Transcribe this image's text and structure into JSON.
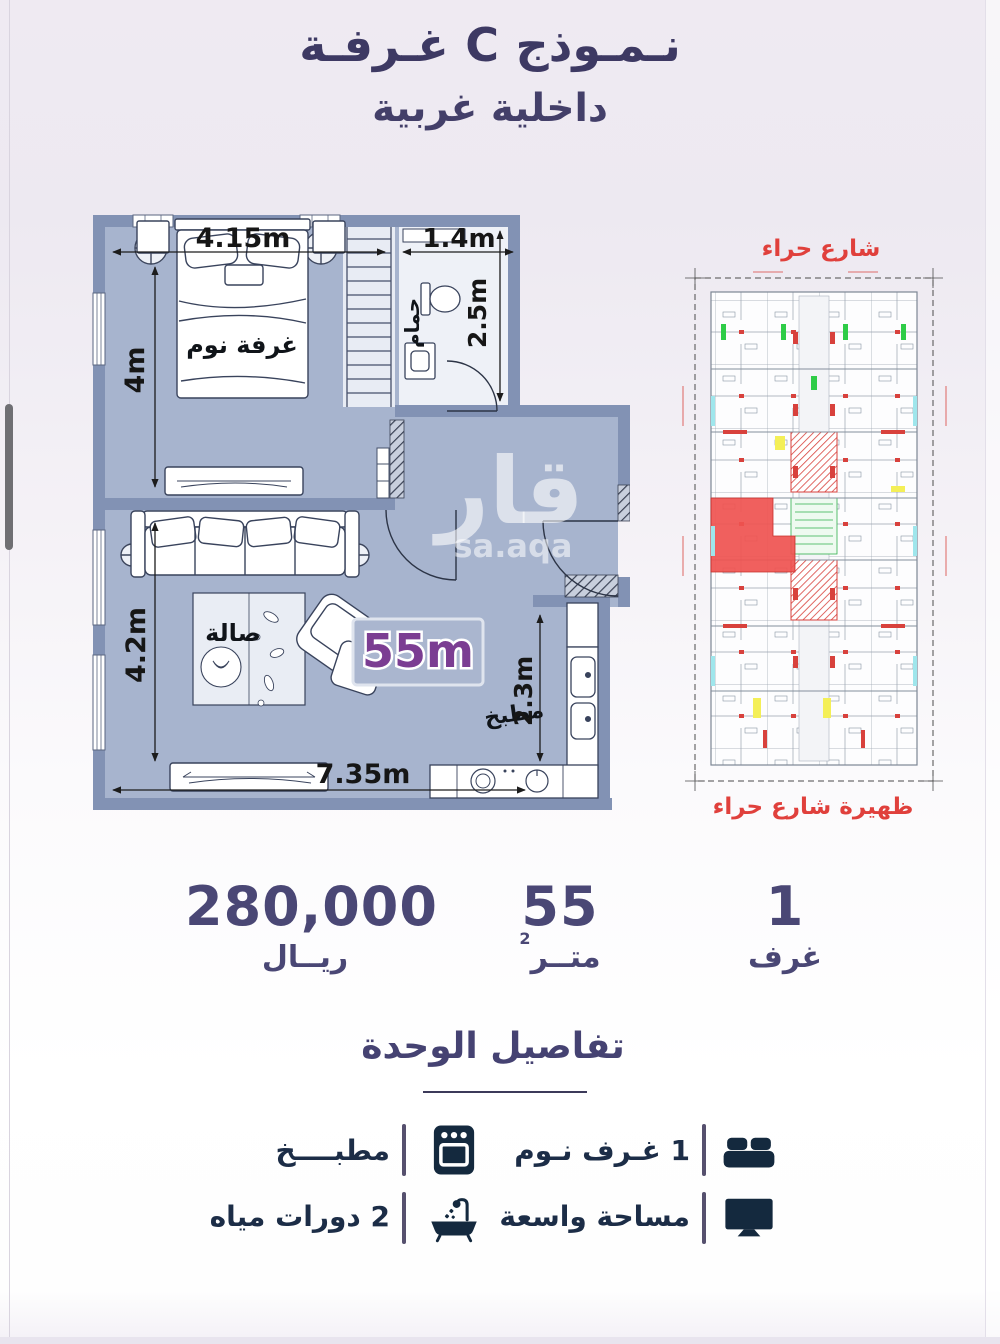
{
  "header": {
    "title_line1": "نـمـوذج C غـرفـة",
    "title_line2": "داخلية غربية"
  },
  "floor_plan": {
    "labels": {
      "bedroom": "غرفة نوم",
      "bathroom": "حمام",
      "living_room": "صالة",
      "kitchen": "مطبخ",
      "area_badge": "55m"
    },
    "dimensions": {
      "bedroom_width": "4.15m",
      "bathroom_width": "1.4m",
      "bedroom_height": "4m",
      "bathroom_height": "2.5m",
      "living_height": "4.2m",
      "living_width": "7.35m",
      "kitchen_width": "2.3m"
    },
    "watermark": {
      "arabic": "قار",
      "latin": "sa.aqa"
    }
  },
  "site_plan": {
    "street_top": "شارع حراء",
    "street_bottom": "ظهيرة شارع حراء"
  },
  "stats": {
    "price": {
      "value": "280,000",
      "label": "ريــال"
    },
    "area": {
      "value": "55",
      "label": "متــر",
      "superscript": "2"
    },
    "rooms": {
      "value": "1",
      "label": "غرف"
    }
  },
  "details": {
    "title": "تفاصيل الوحدة",
    "items": [
      {
        "icon": "bed-icon",
        "label": "1 غـرف نـوم"
      },
      {
        "icon": "oven-icon",
        "label": "مطبــــخ"
      },
      {
        "icon": "monitor-icon",
        "label": "مساحة واسعة"
      },
      {
        "icon": "bathtub-icon",
        "label": "2 دورات مياه"
      }
    ]
  },
  "colors": {
    "accent_purple": "#7b3d92",
    "brand_navy": "#3d3963",
    "icon_navy": "#14293e",
    "street_red": "#e0403c",
    "wall_slate": "#8292b4",
    "floor_blue": "#a7b4ce"
  }
}
